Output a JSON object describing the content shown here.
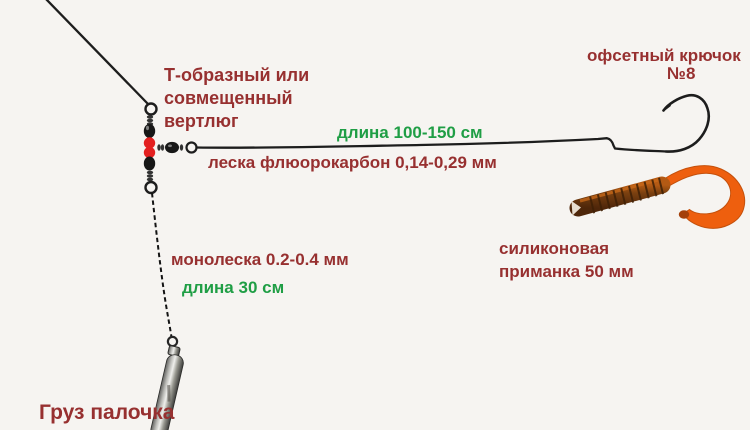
{
  "scene": {
    "description_labels": {
      "swivel_l1": "Т-образный или",
      "swivel_l2": "совмещенный",
      "swivel_l3": "вертлюг",
      "hook_l1": "офсетный крючок",
      "hook_l2": "№8",
      "leader_length": "длина 100-150 см",
      "leader_material": "леска флюорокарбон 0,14-0,29 мм",
      "bait_l1": "силиконовая",
      "bait_l2": "приманка 50 мм",
      "main_line_material": "монолеска 0.2-0.4 мм",
      "dropper_length": "длина 30 см",
      "weight": "Груз палочка"
    },
    "colors": {
      "label_red": "#973030",
      "label_green": "#1f9e45",
      "line": "#1d1d1d",
      "bead_red": "#e32020",
      "bead_black": "#171717",
      "bait_tail_orange": "#ee5f0e",
      "bait_body_brown": "#6b3810",
      "background": "#f6f4f1"
    }
  }
}
